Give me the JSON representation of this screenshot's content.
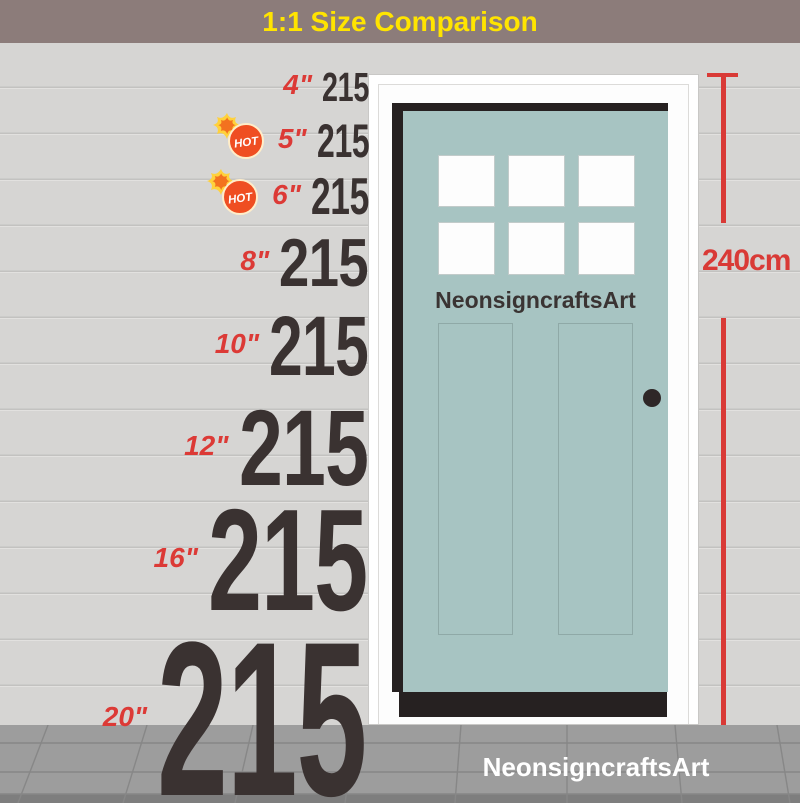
{
  "header": {
    "title": "1:1 Size Comparison"
  },
  "rows": [
    {
      "size": "4\"",
      "value": "215",
      "hot": false
    },
    {
      "size": "5\"",
      "value": "215",
      "hot": true
    },
    {
      "size": "6\"",
      "value": "215",
      "hot": true
    },
    {
      "size": "8\"",
      "value": "215",
      "hot": false
    },
    {
      "size": "10\"",
      "value": "215",
      "hot": false
    },
    {
      "size": "12\"",
      "value": "215",
      "hot": false
    },
    {
      "size": "16\"",
      "value": "215",
      "hot": false
    },
    {
      "size": "20\"",
      "value": "215",
      "hot": false
    }
  ],
  "hot_badge_label": "HOT",
  "door": {
    "brand": "NeonsigncraftsArt"
  },
  "measurement": {
    "label": "240cm"
  },
  "footer": {
    "brand": "NeonsigncraftsArt"
  },
  "colors": {
    "header_bg": "#8c7c7a",
    "title_yellow": "#ffe400",
    "label_red": "#dc3a36",
    "digit_dark": "#3a3231",
    "door_teal": "#a7c4c2",
    "wall_gray": "#d6d5d3",
    "sidewalk_gray": "#9d9d9d",
    "trim_black": "#262121"
  }
}
